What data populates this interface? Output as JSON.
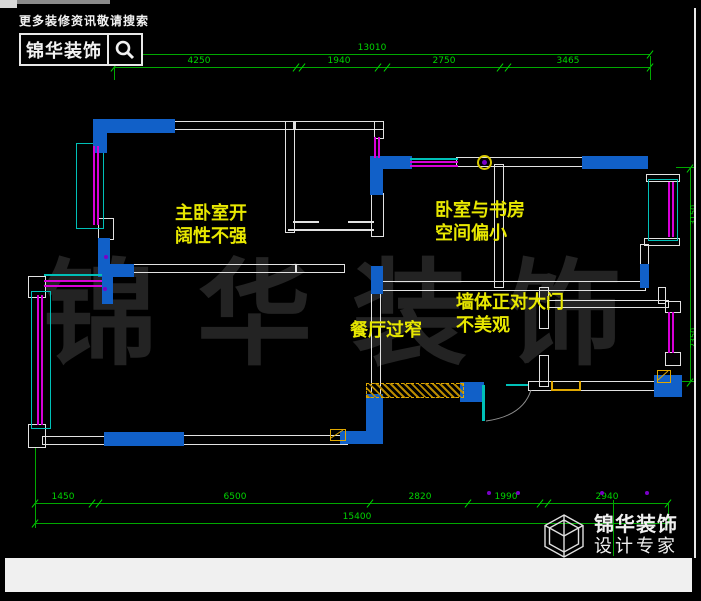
{
  "header": {
    "slogan": "更多装修资讯敬请搜索",
    "brand": "锦华装饰",
    "search_icon": "magnifier"
  },
  "watermark": "锦华装饰",
  "annotations": [
    {
      "id": "master-bedroom-note",
      "text": "主卧室开\n阔性不强"
    },
    {
      "id": "bedroom-study-note",
      "text": "卧室与书房\n空间偏小"
    },
    {
      "id": "dining-note",
      "text": "餐厅过窄"
    },
    {
      "id": "wall-door-note",
      "text": "墙体正对大门\n不美观"
    }
  ],
  "footer": {
    "brand": "锦华装饰",
    "tagline": "设计专家",
    "logo_icon": "wireframe-cube"
  },
  "colors": {
    "wall_blue": "#1160c8",
    "dimension_green": "#00d400",
    "annotation_yellow": "#e8e800",
    "window_magenta": "#d800d8",
    "window_cyan": "#00c0b8"
  },
  "dimensions": {
    "rows": [
      {
        "name": "top-total",
        "y": 54,
        "x1": 135,
        "x2": 650,
        "ticks": [
          135,
          650
        ],
        "labels": [
          {
            "text": "13010",
            "cx": 372
          }
        ]
      },
      {
        "name": "top-chain",
        "y": 67,
        "x1": 114,
        "x2": 650,
        "ticks": [
          114,
          296,
          302,
          378,
          387,
          500,
          508,
          650
        ],
        "labels": [
          {
            "text": "4250",
            "cx": 199
          },
          {
            "text": "1940",
            "cx": 339
          },
          {
            "text": "2750",
            "cx": 444
          },
          {
            "text": "3465",
            "cx": 568
          }
        ]
      },
      {
        "name": "bottom-chain",
        "y": 503,
        "x1": 35,
        "x2": 668,
        "ticks": [
          35,
          92,
          99,
          370,
          468,
          540,
          548,
          668
        ],
        "labels": [
          {
            "text": "1450",
            "cx": 63
          },
          {
            "text": "6500",
            "cx": 235
          },
          {
            "text": "2820",
            "cx": 420
          },
          {
            "text": "1990",
            "cx": 506
          },
          {
            "text": "2940",
            "cx": 607
          }
        ]
      },
      {
        "name": "bottom-total",
        "y": 523,
        "x1": 35,
        "x2": 668,
        "ticks": [
          35,
          668
        ],
        "labels": [
          {
            "text": "15400",
            "cx": 357
          }
        ]
      }
    ],
    "columns": [
      {
        "name": "right-vertical",
        "x": 690,
        "y1": 168,
        "y2": 382,
        "ticks": [
          168,
          382
        ],
        "labels": [
          {
            "text": "3150",
            "cy": 215
          },
          {
            "text": "2350",
            "cy": 338
          }
        ]
      }
    ],
    "extensions": [
      {
        "x": 114,
        "y1": 56,
        "y2": 80
      },
      {
        "x": 650,
        "y1": 56,
        "y2": 80
      },
      {
        "x": 35,
        "y1": 448,
        "y2": 528
      },
      {
        "x": 613,
        "y1": 500,
        "y2": 556
      },
      {
        "x": 668,
        "y1": 503,
        "y2": 523
      }
    ],
    "stubs": [
      {
        "x": 676,
        "y": 167,
        "w": 20
      },
      {
        "x": 672,
        "y": 381,
        "w": 22
      }
    ]
  }
}
